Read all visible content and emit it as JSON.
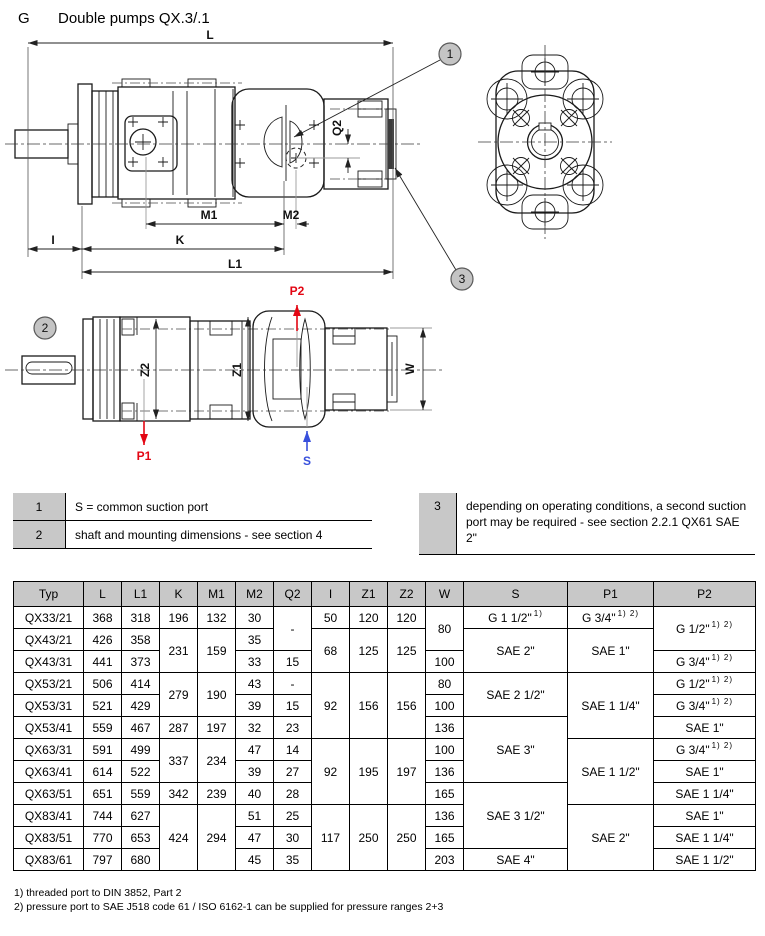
{
  "page": {
    "section_letter": "G",
    "title": "Double pumps QX.3/.1"
  },
  "drawing": {
    "labels": {
      "l": "L",
      "l1": "L1",
      "k": "K",
      "i": "I",
      "m1": "M1",
      "m2": "M2",
      "q2": "Q2",
      "z1": "Z1",
      "z2": "Z2",
      "w": "W"
    },
    "ports": {
      "p1": "P1",
      "p2": "P2",
      "s": "S"
    },
    "callouts": {
      "c1": "1",
      "c2": "2",
      "c3": "3"
    },
    "colors": {
      "pressure_port_red": "#e30613",
      "suction_port_blue": "#3850dc",
      "callout_fill": "#c4c4c4",
      "line": "#1a1a1a"
    }
  },
  "notes": [
    {
      "num": "1",
      "text": "S = common suction port"
    },
    {
      "num": "2",
      "text": "shaft and mounting dimensions - see section 4"
    },
    {
      "num": "3",
      "text": "depending on operating conditions, a second suction port may be required - see section 2.2.1 QX61 SAE 2\""
    }
  ],
  "table": {
    "header_bg": "#c8c8c8",
    "headers": [
      "Typ",
      "L",
      "L1",
      "K",
      "M1",
      "M2",
      "Q2",
      "I",
      "Z1",
      "Z2",
      "W",
      "S",
      "P1",
      "P2"
    ],
    "rows": [
      [
        {
          "v": "QX33/21"
        },
        {
          "v": "368"
        },
        {
          "v": "318"
        },
        {
          "v": "196"
        },
        {
          "v": "132"
        },
        {
          "v": "30"
        },
        {
          "v": "-",
          "rs": 2
        },
        {
          "v": "50"
        },
        {
          "v": "120"
        },
        {
          "v": "120"
        },
        {
          "v": "80",
          "rs": 2
        },
        {
          "v": "G 1 1/2\"",
          "sup": "1)"
        },
        {
          "v": "G 3/4\"",
          "sup": "1) 2)"
        },
        {
          "v": "G 1/2\"",
          "sup": "1) 2)",
          "rs": 2
        }
      ],
      [
        {
          "v": "QX43/21"
        },
        {
          "v": "426"
        },
        {
          "v": "358"
        },
        {
          "v": "231",
          "rs": 2
        },
        {
          "v": "159",
          "rs": 2
        },
        {
          "v": "35"
        },
        {
          "v": "68",
          "rs": 2
        },
        {
          "v": "125",
          "rs": 2
        },
        {
          "v": "125",
          "rs": 2
        },
        {
          "v": "SAE 2\"",
          "rs": 2
        },
        {
          "v": "SAE 1\"",
          "rs": 2
        }
      ],
      [
        {
          "v": "QX43/31"
        },
        {
          "v": "441"
        },
        {
          "v": "373"
        },
        {
          "v": "33"
        },
        {
          "v": "15"
        },
        {
          "v": "100"
        },
        {
          "v": "G 3/4\"",
          "sup": "1) 2)"
        }
      ],
      [
        {
          "v": "QX53/21"
        },
        {
          "v": "506"
        },
        {
          "v": "414"
        },
        {
          "v": "279",
          "rs": 2
        },
        {
          "v": "190",
          "rs": 2
        },
        {
          "v": "43"
        },
        {
          "v": "-"
        },
        {
          "v": "92",
          "rs": 3
        },
        {
          "v": "156",
          "rs": 3
        },
        {
          "v": "156",
          "rs": 3
        },
        {
          "v": "80"
        },
        {
          "v": "SAE 2 1/2\"",
          "rs": 2
        },
        {
          "v": "SAE 1 1/4\"",
          "rs": 3
        },
        {
          "v": "G 1/2\"",
          "sup": "1) 2)"
        }
      ],
      [
        {
          "v": "QX53/31"
        },
        {
          "v": "521"
        },
        {
          "v": "429"
        },
        {
          "v": "39"
        },
        {
          "v": "15"
        },
        {
          "v": "100"
        },
        {
          "v": "G 3/4\"",
          "sup": "1) 2)"
        }
      ],
      [
        {
          "v": "QX53/41"
        },
        {
          "v": "559"
        },
        {
          "v": "467"
        },
        {
          "v": "287"
        },
        {
          "v": "197"
        },
        {
          "v": "32"
        },
        {
          "v": "23"
        },
        {
          "v": "136"
        },
        {
          "v": "SAE 3\"",
          "rs": 3
        },
        {
          "v": "SAE 1\""
        }
      ],
      [
        {
          "v": "QX63/31"
        },
        {
          "v": "591"
        },
        {
          "v": "499"
        },
        {
          "v": "337",
          "rs": 2
        },
        {
          "v": "234",
          "rs": 2
        },
        {
          "v": "47"
        },
        {
          "v": "14"
        },
        {
          "v": "92",
          "rs": 3
        },
        {
          "v": "195",
          "rs": 3
        },
        {
          "v": "197",
          "rs": 3
        },
        {
          "v": "100"
        },
        {
          "v": "SAE 1 1/2\"",
          "rs": 3
        },
        {
          "v": "G 3/4\"",
          "sup": "1) 2)"
        }
      ],
      [
        {
          "v": "QX63/41"
        },
        {
          "v": "614"
        },
        {
          "v": "522"
        },
        {
          "v": "39"
        },
        {
          "v": "27"
        },
        {
          "v": "136"
        },
        {
          "v": "SAE 1\""
        }
      ],
      [
        {
          "v": "QX63/51"
        },
        {
          "v": "651"
        },
        {
          "v": "559"
        },
        {
          "v": "342"
        },
        {
          "v": "239"
        },
        {
          "v": "40"
        },
        {
          "v": "28"
        },
        {
          "v": "165"
        },
        {
          "v": "SAE 3 1/2\"",
          "rs": 3
        },
        {
          "v": "SAE 1 1/4\""
        }
      ],
      [
        {
          "v": "QX83/41"
        },
        {
          "v": "744"
        },
        {
          "v": "627"
        },
        {
          "v": "424",
          "rs": 3
        },
        {
          "v": "294",
          "rs": 3
        },
        {
          "v": "51"
        },
        {
          "v": "25"
        },
        {
          "v": "117",
          "rs": 3
        },
        {
          "v": "250",
          "rs": 3
        },
        {
          "v": "250",
          "rs": 3
        },
        {
          "v": "136"
        },
        {
          "v": "SAE 2\"",
          "rs": 3
        },
        {
          "v": "SAE 1\""
        }
      ],
      [
        {
          "v": "QX83/51"
        },
        {
          "v": "770"
        },
        {
          "v": "653"
        },
        {
          "v": "47"
        },
        {
          "v": "30"
        },
        {
          "v": "165"
        },
        {
          "v": "SAE 1 1/4\""
        }
      ],
      [
        {
          "v": "QX83/61"
        },
        {
          "v": "797"
        },
        {
          "v": "680"
        },
        {
          "v": "45"
        },
        {
          "v": "35"
        },
        {
          "v": "203"
        },
        {
          "v": "SAE 4\""
        },
        {
          "v": "SAE 1 1/2\""
        }
      ]
    ]
  },
  "footnotes": [
    "1) threaded port to DIN 3852, Part 2",
    "2) pressure port to SAE J518 code 61 / ISO 6162-1 can be supplied for pressure ranges 2+3"
  ]
}
